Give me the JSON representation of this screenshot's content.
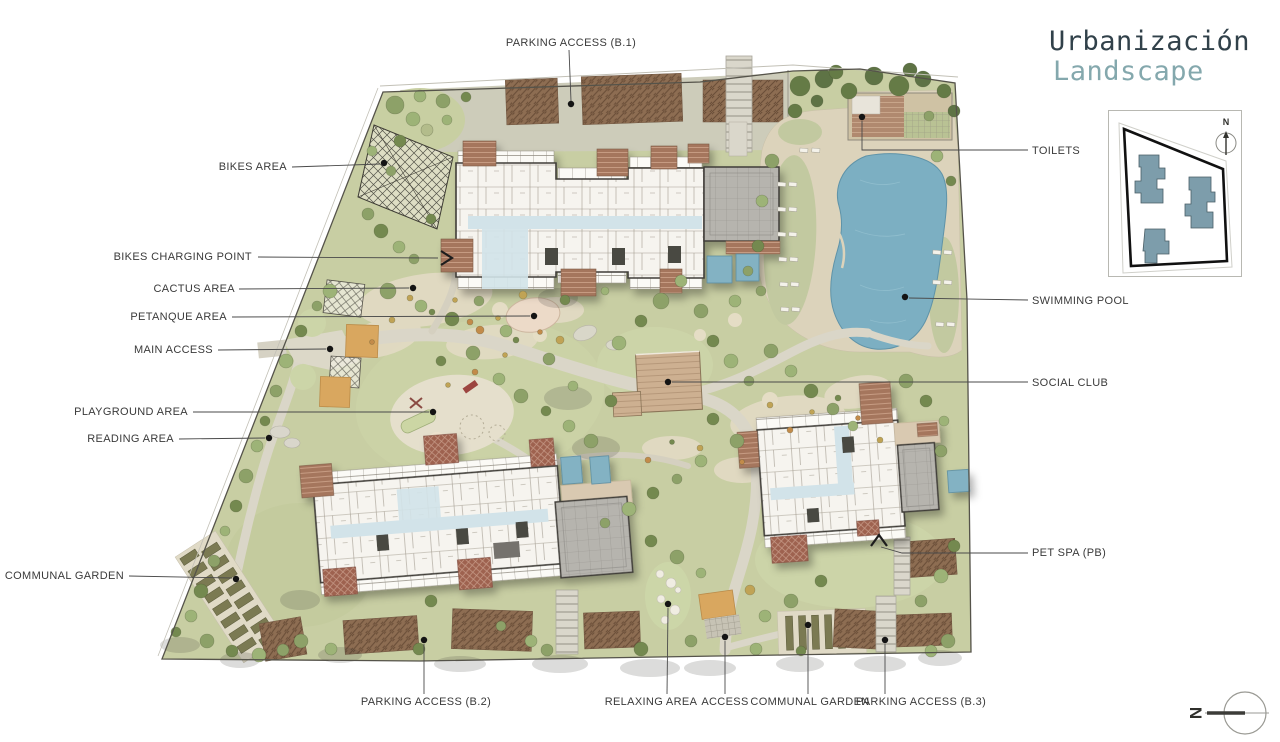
{
  "title": {
    "line1": "Urbanización",
    "line2": "Landscape"
  },
  "callouts": {
    "top": [
      {
        "label": "PARKING ACCESS (B.1)"
      }
    ],
    "left": [
      {
        "label": "BIKES AREA"
      },
      {
        "label": "BIKES CHARGING POINT"
      },
      {
        "label": "CACTUS AREA"
      },
      {
        "label": "PETANQUE AREA"
      },
      {
        "label": "MAIN ACCESS"
      },
      {
        "label": "PLAYGROUND AREA"
      },
      {
        "label": "READING AREA"
      },
      {
        "label": "COMMUNAL GARDEN"
      }
    ],
    "right": [
      {
        "label": "TOILETS"
      },
      {
        "label": "SWIMMING POOL"
      },
      {
        "label": "SOCIAL CLUB"
      },
      {
        "label": "PET SPA (PB)"
      }
    ],
    "bottom": [
      {
        "label": "PARKING ACCESS (B.2)"
      },
      {
        "label": "RELAXING AREA"
      },
      {
        "label": "ACCESS"
      },
      {
        "label": "COMMUNAL GARDEN"
      },
      {
        "label": "PARKING ACCESS (B.3)"
      }
    ]
  },
  "key_plan": {
    "north_label": "N"
  },
  "compass": {
    "north_label": "N"
  },
  "colors": {
    "accent_teal": "#84a8ad",
    "ink": "#31414a",
    "label_ink": "#3a3a3a",
    "site_green": "#c8cea3",
    "pool_blue": "#7cafc2",
    "building_white": "#f6f4ef",
    "deck_brown": "#a5765d",
    "key_building_teal": "#7d9dab"
  }
}
